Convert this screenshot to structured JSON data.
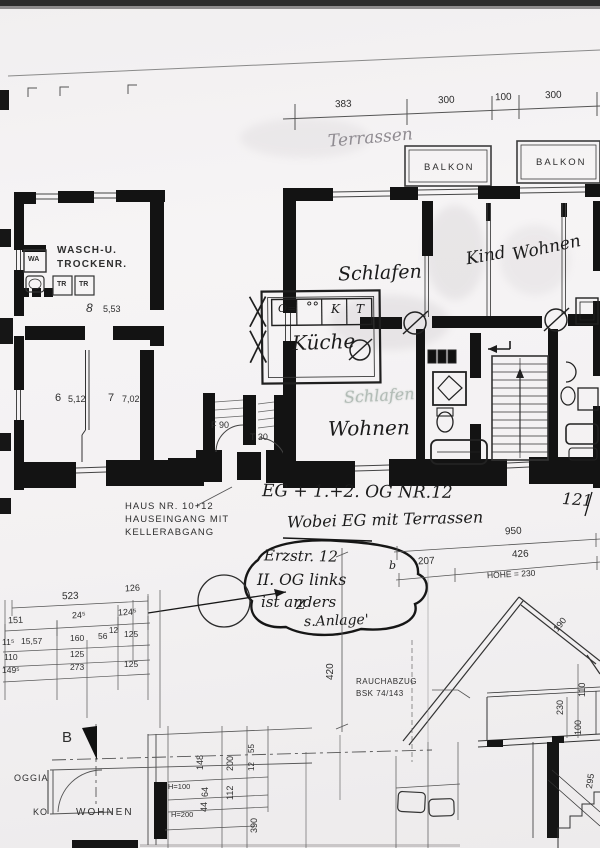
{
  "top_dims": {
    "d1": "383",
    "d2": "300",
    "d3": "100",
    "d4": "300"
  },
  "balconies": {
    "b1": "BALKON",
    "b2": "BALKON"
  },
  "terrace_note": "Terrassen",
  "rooms": {
    "schlafen": "Schlafen",
    "kind": "Kind",
    "wohnen_top": "Wohnen",
    "kueche": "Küche",
    "wohnen_mid": "Wohnen",
    "schlafen_ghost": "Schlafen",
    "wasch1": "WASCH-U.",
    "wasch2": "TROCKENR.",
    "wa": "WA",
    "tr1": "TR",
    "tr2": "TR",
    "r8_no": "8",
    "r8_area": "5,53",
    "r6_no": "6",
    "r6_area": "5,12",
    "r7_no": "7",
    "r7_area": "7,02",
    "loggia": "OGGIA",
    "ko": "KO",
    "wohnen_bottom": "WOHNEN"
  },
  "kueche_cells": {
    "c1": "O=",
    "c2": "°°",
    "c3": "K",
    "c4": "T"
  },
  "doors": {
    "f90": "F 90",
    "t30": "T 30"
  },
  "entrance_note": {
    "l1": "HAUS NR. 10+12",
    "l2": "HAUSEINGANG MIT",
    "l3": "KELLERABGANG"
  },
  "hand_notes": {
    "title": "EG + 1.+2. OG  NR.12",
    "sub": "Wobei EG mit Terrassen",
    "right_mark": "121",
    "bubble_l1": "Erzstr. 12",
    "bubble_l2": "II. OG links",
    "bubble_l3": "ist anders",
    "bubble_z": "Z",
    "bubble_l4": "s.Anlage'",
    "misc_b": "b"
  },
  "right_dims": {
    "overall": "950",
    "d1": "207",
    "d2": "426",
    "hoehe": "HÖHE = 230"
  },
  "left_dims": {
    "total": "523",
    "r1b": "126",
    "r2": [
      "151",
      "24⁵",
      "124⁵"
    ],
    "r3": [
      "11⁵",
      "15,57",
      "160",
      "56",
      "12",
      "125"
    ],
    "r4": [
      "110",
      "125"
    ],
    "r5": [
      "149⁵",
      "273",
      "125"
    ]
  },
  "vert_dim": "420",
  "section": {
    "rauch1": "RAUCHABZUG",
    "rauch2": "BSK 74/143",
    "d_roof": "190",
    "d1": "110",
    "d2": "230",
    "d3": "100",
    "d4": "295"
  },
  "bottom_dims": {
    "b_marker": "B",
    "h1": "H=100",
    "h2": "H=200",
    "r": [
      "148",
      "200",
      "55",
      "12",
      "64",
      "112",
      "44",
      "390"
    ]
  },
  "colors": {
    "ink": "#1b1b1b",
    "print": "#2e2e2e",
    "pencil": "#8f8b91",
    "paper": "#f3f1f2"
  }
}
